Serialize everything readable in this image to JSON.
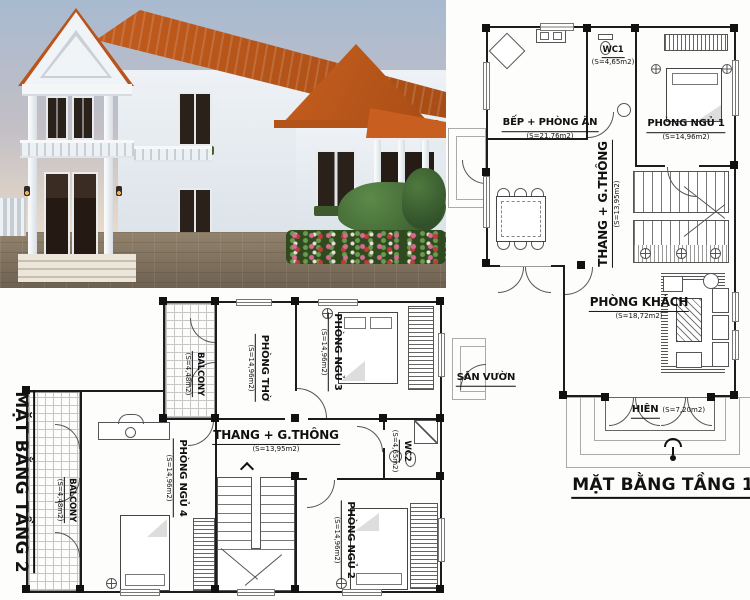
{
  "colors": {
    "plan-line": "#1c1c1c",
    "sky-top": "#a8bad0",
    "sky-mid": "#c3bfc5",
    "sky-bottom": "#e8dac9",
    "roof": "#c85f20",
    "roof-dark": "#a84d15",
    "wall-light": "#eef2f6",
    "wall-shade": "#dce3e9",
    "door-dark": "#271c15",
    "grass": "#4a6f38",
    "ground": "#8a7a66"
  },
  "plan1": {
    "title": "MẶT BẰNG TẦNG 1",
    "rooms": {
      "wc1": {
        "name": "WC1",
        "area": "(S=4,65m2)"
      },
      "kitchen": {
        "name": "BẾP + PHÒNG ĂN",
        "area": "(S=21,76m2)"
      },
      "bedroom1": {
        "name": "PHÒNG NGỦ 1",
        "area": "(S=14,96m2)"
      },
      "stairs": {
        "name": "THANG + G.THÔNG",
        "area": "(S=13,95m2)"
      },
      "living": {
        "name": "PHÒNG KHÁCH",
        "area": "(S=18,72m2)"
      },
      "porch": {
        "name": "HIÊN",
        "area": "(S=7,20m2)"
      },
      "garden": {
        "name": "SÂN VƯỜN",
        "area": ""
      }
    }
  },
  "plan2": {
    "title": "MẶT BẰNG TẦNG 2",
    "rooms": {
      "balcony_top": {
        "name": "BALCONY",
        "area": "(S=4,48m2)"
      },
      "worship": {
        "name": "PHÒNG THỜ",
        "area": "(S=14,96m2)"
      },
      "bedroom3": {
        "name": "PHÒNG NGỦ 3",
        "area": "(S=14,96m2)"
      },
      "stairs": {
        "name": "THANG + G.THÔNG",
        "area": "(S=13,95m2)"
      },
      "wc2": {
        "name": "WC2",
        "area": "(S=4,65m2)"
      },
      "bedroom4": {
        "name": "PHÒNG NGỦ 4",
        "area": "(S=14,96m2)"
      },
      "balcony_left": {
        "name": "BALCONY",
        "area": "(S=4,48m2)"
      },
      "bedroom2": {
        "name": "PHÒNG NGỦ 2",
        "area": "(S=14,96m2)"
      }
    }
  }
}
